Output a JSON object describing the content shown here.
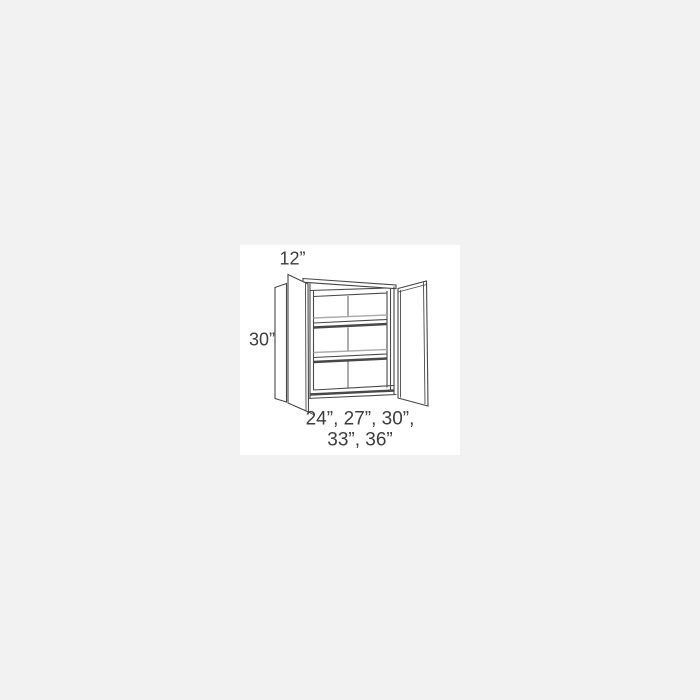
{
  "page": {
    "background": "#f2f2f2",
    "image_area_background": "#ffffff"
  },
  "diagram": {
    "figure_alt": "line drawing of a double-door wall cabinet with open doors and two interior shelves",
    "dimensions": {
      "depth_label": "12”",
      "height_label": "30”",
      "width_options_line1": "24”, 27”, 30”,",
      "width_options_line2": "33”, 36”"
    },
    "colors": {
      "line": "#484848",
      "line_light": "#ababab",
      "text": "#3d3d3d"
    }
  }
}
